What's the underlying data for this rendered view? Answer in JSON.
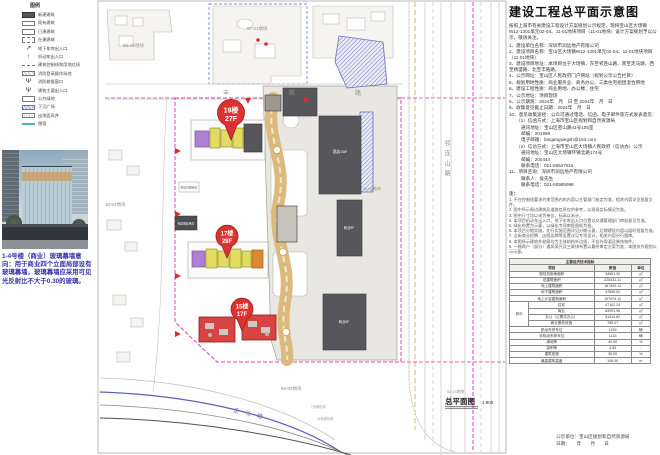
{
  "legend": {
    "title": "图例",
    "items": [
      {
        "label": "新建建筑",
        "sw": "solid",
        "icon": "new-building-swatch"
      },
      {
        "label": "既有建筑",
        "sw": "outline",
        "icon": "existing-building-swatch"
      },
      {
        "label": "已建建筑",
        "sw": "outline",
        "icon": "built-building-swatch"
      },
      {
        "label": "在建建筑",
        "sw": "dashed",
        "icon": "under-construction-swatch"
      },
      {
        "label": "地下车库出入口",
        "sw": "sym",
        "glyph": "↗",
        "icon": "garage-entrance-icon"
      },
      {
        "label": "机动车出入口",
        "sw": "sym",
        "glyph": "↑",
        "icon": "vehicle-entrance-icon"
      },
      {
        "label": "建筑控制线和用地红线",
        "sw": "pink",
        "icon": "red-line-swatch"
      },
      {
        "label": "消防登高操作场地",
        "sw": "hatchg",
        "icon": "fire-operation-area-swatch"
      },
      {
        "label": "消防救援窗口",
        "sw": "sym",
        "glyph": "Ψ",
        "icon": "fire-rescue-window-icon"
      },
      {
        "label": "建筑主要出入口",
        "sw": "sym",
        "glyph": "Ψ",
        "icon": "main-entrance-icon"
      },
      {
        "label": "公共绿地",
        "sw": "outline",
        "icon": "public-green-swatch"
      },
      {
        "label": "下沉广场",
        "sw": "hatchb",
        "icon": "sunken-plaza-swatch"
      },
      {
        "label": "出地面风井",
        "sw": "dotg",
        "icon": "vent-shaft-swatch"
      },
      {
        "label": "围墙",
        "sw": "cyan",
        "icon": "fence-line-swatch"
      }
    ]
  },
  "photo_caption": "1-4号楼（商业）玻璃幕墙意向：用于商业四个立面局部设有玻璃幕墙，玻璃幕墙应采用可见光反射比不大于0.30的玻璃。",
  "map": {
    "parcels": {
      "p1": "B6-06地块",
      "p2": "07-01地块",
      "p3": "10-04地块",
      "p4": "11-02地块",
      "p5": "62-03地块",
      "p6": "02-03地块"
    },
    "roads": {
      "top": "丰皓路",
      "right": "祁连山路",
      "water": "走马塘"
    },
    "buildings": {
      "hotel": "酒店30F",
      "mall": "商业9F",
      "mall2": "商业3F",
      "service": "社区配套用房",
      "property": "物业管理用房"
    },
    "annotations": {
      "a1": "7米绿化带",
      "a2": "15米绿化带"
    },
    "badges": [
      {
        "l1": "19楼",
        "l2": "27F"
      },
      {
        "l1": "17楼",
        "l2": "28F"
      },
      {
        "l1": "15楼",
        "l2": "17F"
      }
    ],
    "plan_label": "总平面图",
    "plan_scale": "1:800"
  },
  "panel": {
    "title": "建设工程总平面示意图",
    "intro": "按照上海市有关建设工程设计方案规划公示规定，现将宝山区大场镇W12-1301单元02-04、11-01地块项目（11-01地块）设计方案规划予以公示，敬请关注。",
    "items": [
      {
        "t": "1、建设单位名称：深圳市润远地产有限公司"
      },
      {
        "t": "2、建设项目名称：宝山区大场镇W12-1301单元02-04、11-01地块项目（11-01地块）"
      },
      {
        "t": "3、建设项目地址：本项目位于大场镇，东至祁连山路、南至走马塘、西至杨盛路、北至丰皓路。"
      },
      {
        "t": "4、公示网址：宝山区人民政府门户网站（规划公示公告栏目）"
      },
      {
        "t": "5、规划用地性质：商业服务业、商务办公、三类住宅组团混合用地"
      },
      {
        "t": "6、建设工程性质：商业用地、办公楼、住宅"
      },
      {
        "t": "7、公示地址：项目现场"
      },
      {
        "t": "8、公示期限：2024年　月　日 至 2024年　月　日"
      },
      {
        "t": "9、收集意见截止日期：2024年　月　日"
      },
      {
        "t": "10、意见收集途径：公众可通过电话、信函、电子邮件等方式发表意见：",
        "ind": 0
      },
      {
        "t": "（1）信函方式：上海市宝山区规划和自然资源局",
        "ind": 1
      },
      {
        "t": "通讯地址：宝山区密山路41号105室",
        "ind": 2
      },
      {
        "t": "邮编：201999",
        "ind": 2
      },
      {
        "t": "电子邮箱：fangangxiegsh@163.com",
        "ind": 2
      },
      {
        "t": "（2）信访方式：上海市宝山区大场镇人民政府（信访办）公示",
        "ind": 1
      },
      {
        "t": "通讯地址：宝山区大场镇环镇北路174号",
        "ind": 2
      },
      {
        "t": "邮编：200444",
        "ind": 2
      },
      {
        "t": "联系电话：021-56527816",
        "ind": 2
      },
      {
        "t": "11、项目咨询：深圳市润远地产有限公司"
      },
      {
        "t": "联系人：侯先生",
        "ind": 2
      },
      {
        "t": "联系电话：021-55985998",
        "ind": 2
      }
    ],
    "notes_title": "注：",
    "notes": [
      "1. 不在控制线要求约束范围内的内容以主管部门核定为准，相关内容详见批复文件。",
      "2. 图中所示周边建筑及道路信息仅供参考，以现场实际情况为准。",
      "3. 图中尺寸均以米为单位，标高以米计。",
      "4. 本项目机动车出入口、地下车库出入口位置以交通管理部门审批意见为准。",
      "5. 绿化布置为示意，以绿化专项审批图纸为准。",
      "6. 本项目分期实施，先行实施范围详见分期示意，后期建设内容以届时批复为准。",
      "7. 沿街商业招牌、店招店牌等设置详见专项设计，相关内容另行报审。",
      "8. 本图所示建筑外轮廓均为主体结构外边线，不含外保温及装饰构件。",
      "9. 一梯两户（部分）通风采光及三联排布置以最终审定方案为准，本图仅作规划公示示意。"
    ],
    "table": {
      "rows": [
        {
          "cells": [
            {
              "t": "主要经济技术指标",
              "cs": 4,
              "h": true
            }
          ]
        },
        {
          "cells": [
            {
              "t": "项目",
              "cs": 2,
              "h": true
            },
            {
              "t": "数值",
              "h": true
            },
            {
              "t": "单位",
              "h": true
            }
          ]
        },
        {
          "cells": [
            {
              "t": "规划总用地面积",
              "cs": 2
            },
            {
              "t": "34561.30"
            },
            {
              "t": "㎡"
            }
          ]
        },
        {
          "cells": [
            {
              "t": "总建筑面积",
              "cs": 2
            },
            {
              "t": "225431.11"
            },
            {
              "t": "㎡"
            }
          ]
        },
        {
          "cells": [
            {
              "t": "地上建筑面积",
              "cs": 2
            },
            {
              "t": "167420.11"
            },
            {
              "t": "㎡"
            }
          ]
        },
        {
          "cells": [
            {
              "t": "地下建筑面积",
              "cs": 2
            },
            {
              "t": "47890.00"
            },
            {
              "t": "㎡"
            }
          ]
        },
        {
          "cells": [
            {
              "t": "地上计容建筑面积",
              "cs": 2
            },
            {
              "t": "157074.12"
            },
            {
              "t": "㎡"
            }
          ]
        },
        {
          "cells": [
            {
              "t": "其中",
              "rs": 4
            },
            {
              "t": "住宅"
            },
            {
              "t": "47102.24"
            },
            {
              "t": "㎡"
            }
          ]
        },
        {
          "cells": [
            {
              "t": "商业"
            },
            {
              "t": "63991.96"
            },
            {
              "t": "㎡"
            }
          ]
        },
        {
          "cells": [
            {
              "t": "办公（公寓式办公）"
            },
            {
              "t": "31414.62"
            },
            {
              "t": "㎡"
            }
          ]
        },
        {
          "cells": [
            {
              "t": "商业服务设施"
            },
            {
              "t": "785.07"
            },
            {
              "t": "㎡"
            }
          ]
        },
        {
          "cells": [
            {
              "t": "机动车停车位",
              "cs": 2
            },
            {
              "t": "1159"
            },
            {
              "t": "辆"
            }
          ]
        },
        {
          "cells": [
            {
              "t": "非机动车停车位",
              "cs": 2
            },
            {
              "t": "1133"
            },
            {
              "t": "辆"
            }
          ]
        },
        {
          "cells": [
            {
              "t": "绿地率",
              "cs": 2
            },
            {
              "t": "40.00"
            },
            {
              "t": "%"
            }
          ]
        },
        {
          "cells": [
            {
              "t": "容积率",
              "cs": 2
            },
            {
              "t": "4.55"
            },
            {
              "t": "-"
            }
          ]
        },
        {
          "cells": [
            {
              "t": "建筑密度",
              "cs": 2
            },
            {
              "t": "35.00"
            },
            {
              "t": "%"
            }
          ]
        },
        {
          "cells": [
            {
              "t": "最高建筑高度",
              "cs": 2
            },
            {
              "t": "106.00"
            },
            {
              "t": "m"
            }
          ]
        }
      ]
    }
  },
  "footer": {
    "publisher": "公示单位：宝山区规划和自然资源局",
    "date": "日期：　　年　　月　　日"
  }
}
